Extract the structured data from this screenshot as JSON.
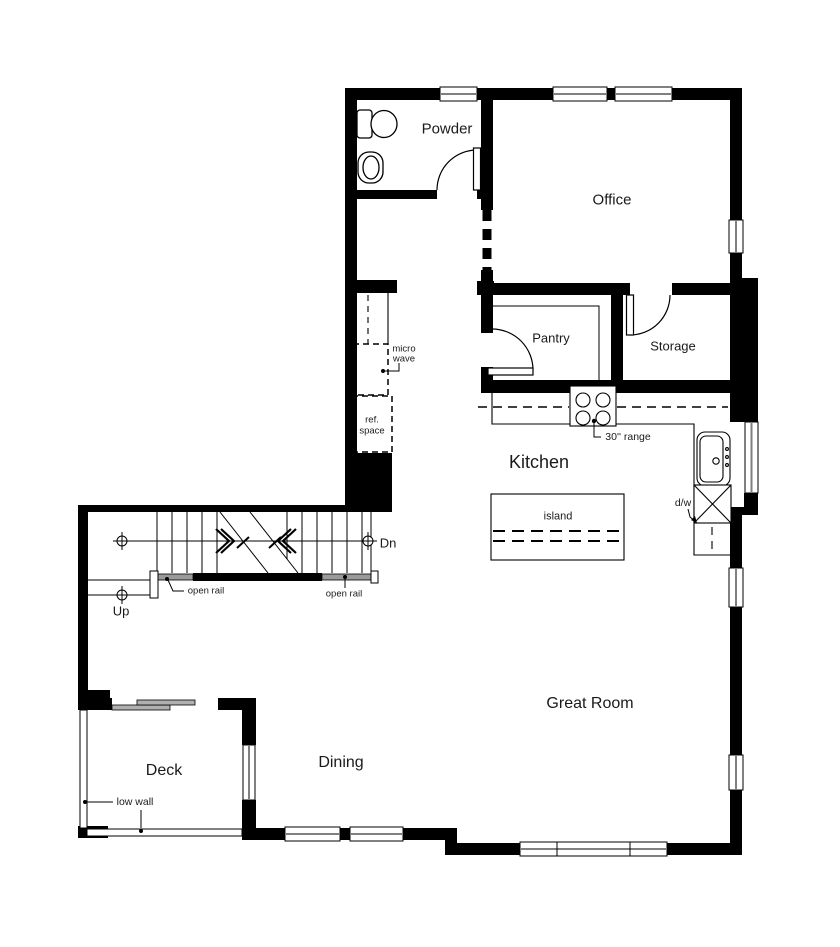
{
  "rooms": {
    "powder": "Powder",
    "office": "Office",
    "pantry": "Pantry",
    "storage": "Storage",
    "kitchen": "Kitchen",
    "great_room": "Great Room",
    "dining": "Dining",
    "deck": "Deck"
  },
  "stairs": {
    "up": "Up",
    "down": "Dn",
    "open_rail_left": "open rail",
    "open_rail_right": "open rail"
  },
  "annotations": {
    "microwave_line1": "micro",
    "microwave_line2": "wave",
    "ref_space_line1": "ref.",
    "ref_space_line2": "space",
    "range": "30'' range",
    "island": "island",
    "dishwasher": "d/w",
    "low_wall": "low wall"
  },
  "colors": {
    "walls": "#000000",
    "background": "#ffffff",
    "text": "#1a1a1a",
    "rail_gray": "#9a9a9a",
    "glass_gray": "#808080"
  }
}
